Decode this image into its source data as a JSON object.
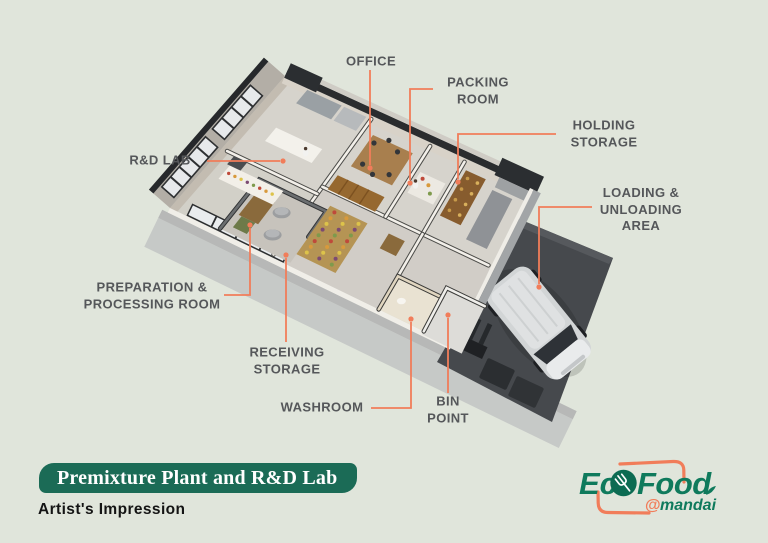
{
  "plan_labels": [
    {
      "id": "office",
      "lines": [
        "OFFICE"
      ]
    },
    {
      "id": "packing-room",
      "lines": [
        "PACKING",
        "ROOM"
      ]
    },
    {
      "id": "holding-storage",
      "lines": [
        "HOLDING",
        "STORAGE"
      ]
    },
    {
      "id": "loading-unloading-area",
      "lines": [
        "LOADING &",
        "UNLOADING",
        "AREA"
      ]
    },
    {
      "id": "rd-lab",
      "lines": [
        "R&D LAB"
      ]
    },
    {
      "id": "preparation-processing-room",
      "lines": [
        "PREPARATION &",
        "PROCESSING ROOM"
      ]
    },
    {
      "id": "receiving-storage",
      "lines": [
        "RECEIVING",
        "STORAGE"
      ]
    },
    {
      "id": "washroom",
      "lines": [
        "WASHROOM"
      ]
    },
    {
      "id": "bin-point",
      "lines": [
        "BIN",
        "POINT"
      ]
    }
  ],
  "title_banner": {
    "title": "Premixture Plant and R&D Lab",
    "subtitle": "Artist's Impression"
  },
  "logo": {
    "brand": "EcoFood",
    "brand_prefix": "Ec",
    "o_icon": "leaf-fork-icon",
    "brand_suffix": "Food",
    "at_symbol": "@",
    "location": "mandai"
  },
  "colors": {
    "background": "#e0e5db",
    "accent_orange": "#f17d5a",
    "banner_green": "#1b6b56",
    "logo_green": "#0f7a5c",
    "label_gray": "#55575a"
  }
}
